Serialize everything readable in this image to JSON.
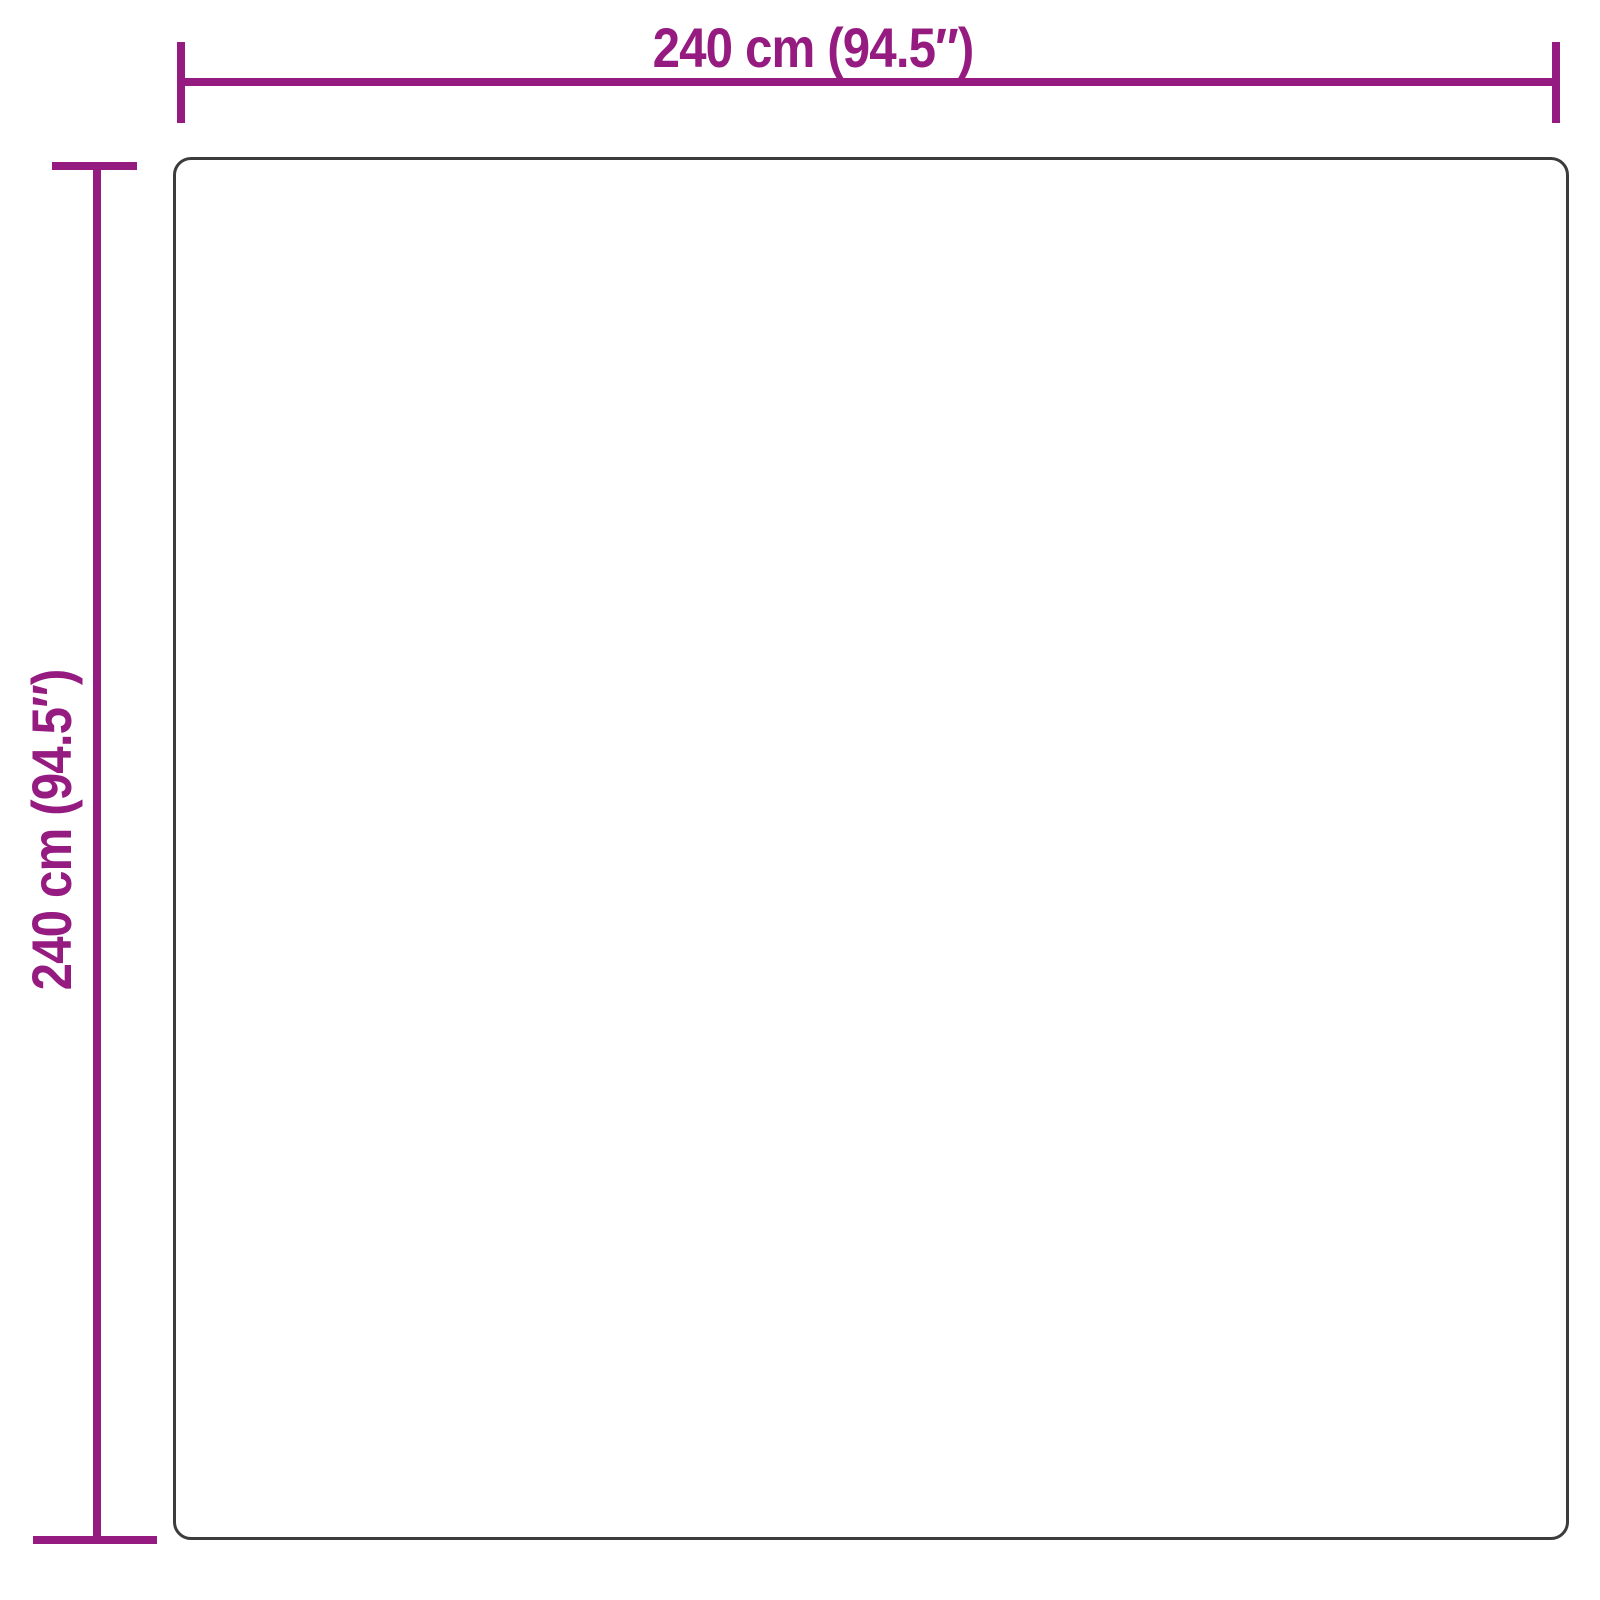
{
  "diagram": {
    "type": "product-dimension-diagram",
    "shape": "square",
    "width_label": "240 cm (94.5″)",
    "height_label": "240 cm (94.5″)",
    "width_cm": 240,
    "height_cm": 240,
    "width_inches": 94.5,
    "height_inches": 94.5,
    "dimension_color": "#951B81",
    "outline_color": "#3C3C3C",
    "background_color": "#FFFFFF"
  }
}
